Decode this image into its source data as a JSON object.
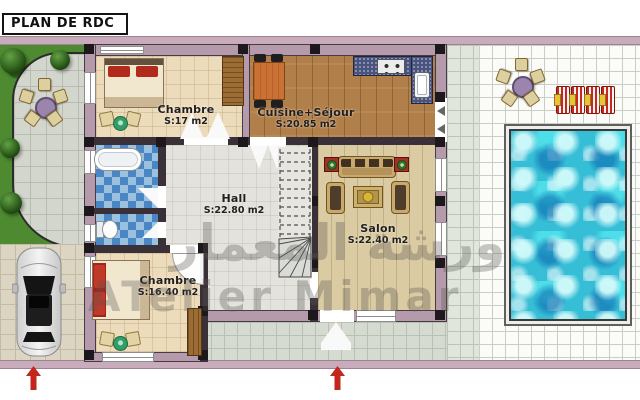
{
  "title": "PLAN DE RDC",
  "watermark": {
    "arabic": "ورشة المعمار",
    "latin": "ATelier Mimar"
  },
  "rooms": [
    {
      "name": "Chambre",
      "area": "S:17 m2"
    },
    {
      "name": "Cuisine+Séjour",
      "area": "S:20.85 m2"
    },
    {
      "name": "Hall",
      "area": "S:22.80 m2"
    },
    {
      "name": "Salon",
      "area": "S:22.40 m2"
    },
    {
      "name": "Chambre",
      "area": "S:16.40 m2"
    }
  ],
  "colors": {
    "boundary_wall": "#c9acbb",
    "wall_fill": "#b59aab",
    "wall_dark": "#3a3138",
    "column": "#1d181c",
    "grass": "#4d8a30",
    "pool_water": "#36bed6",
    "arrow": "#c3261b",
    "bedroom_floor": "#eddcbc",
    "kitchen_floor": "#b17f49",
    "salon_floor": "#dacba3",
    "hall_floor": "#e3e2dc",
    "bath_tile": "#4a86c4",
    "bath_tile_light": "#9cc1df",
    "counter": "#49537e",
    "label_text": "#211e1c",
    "watermark": "rgba(88,85,80,0.32)"
  }
}
